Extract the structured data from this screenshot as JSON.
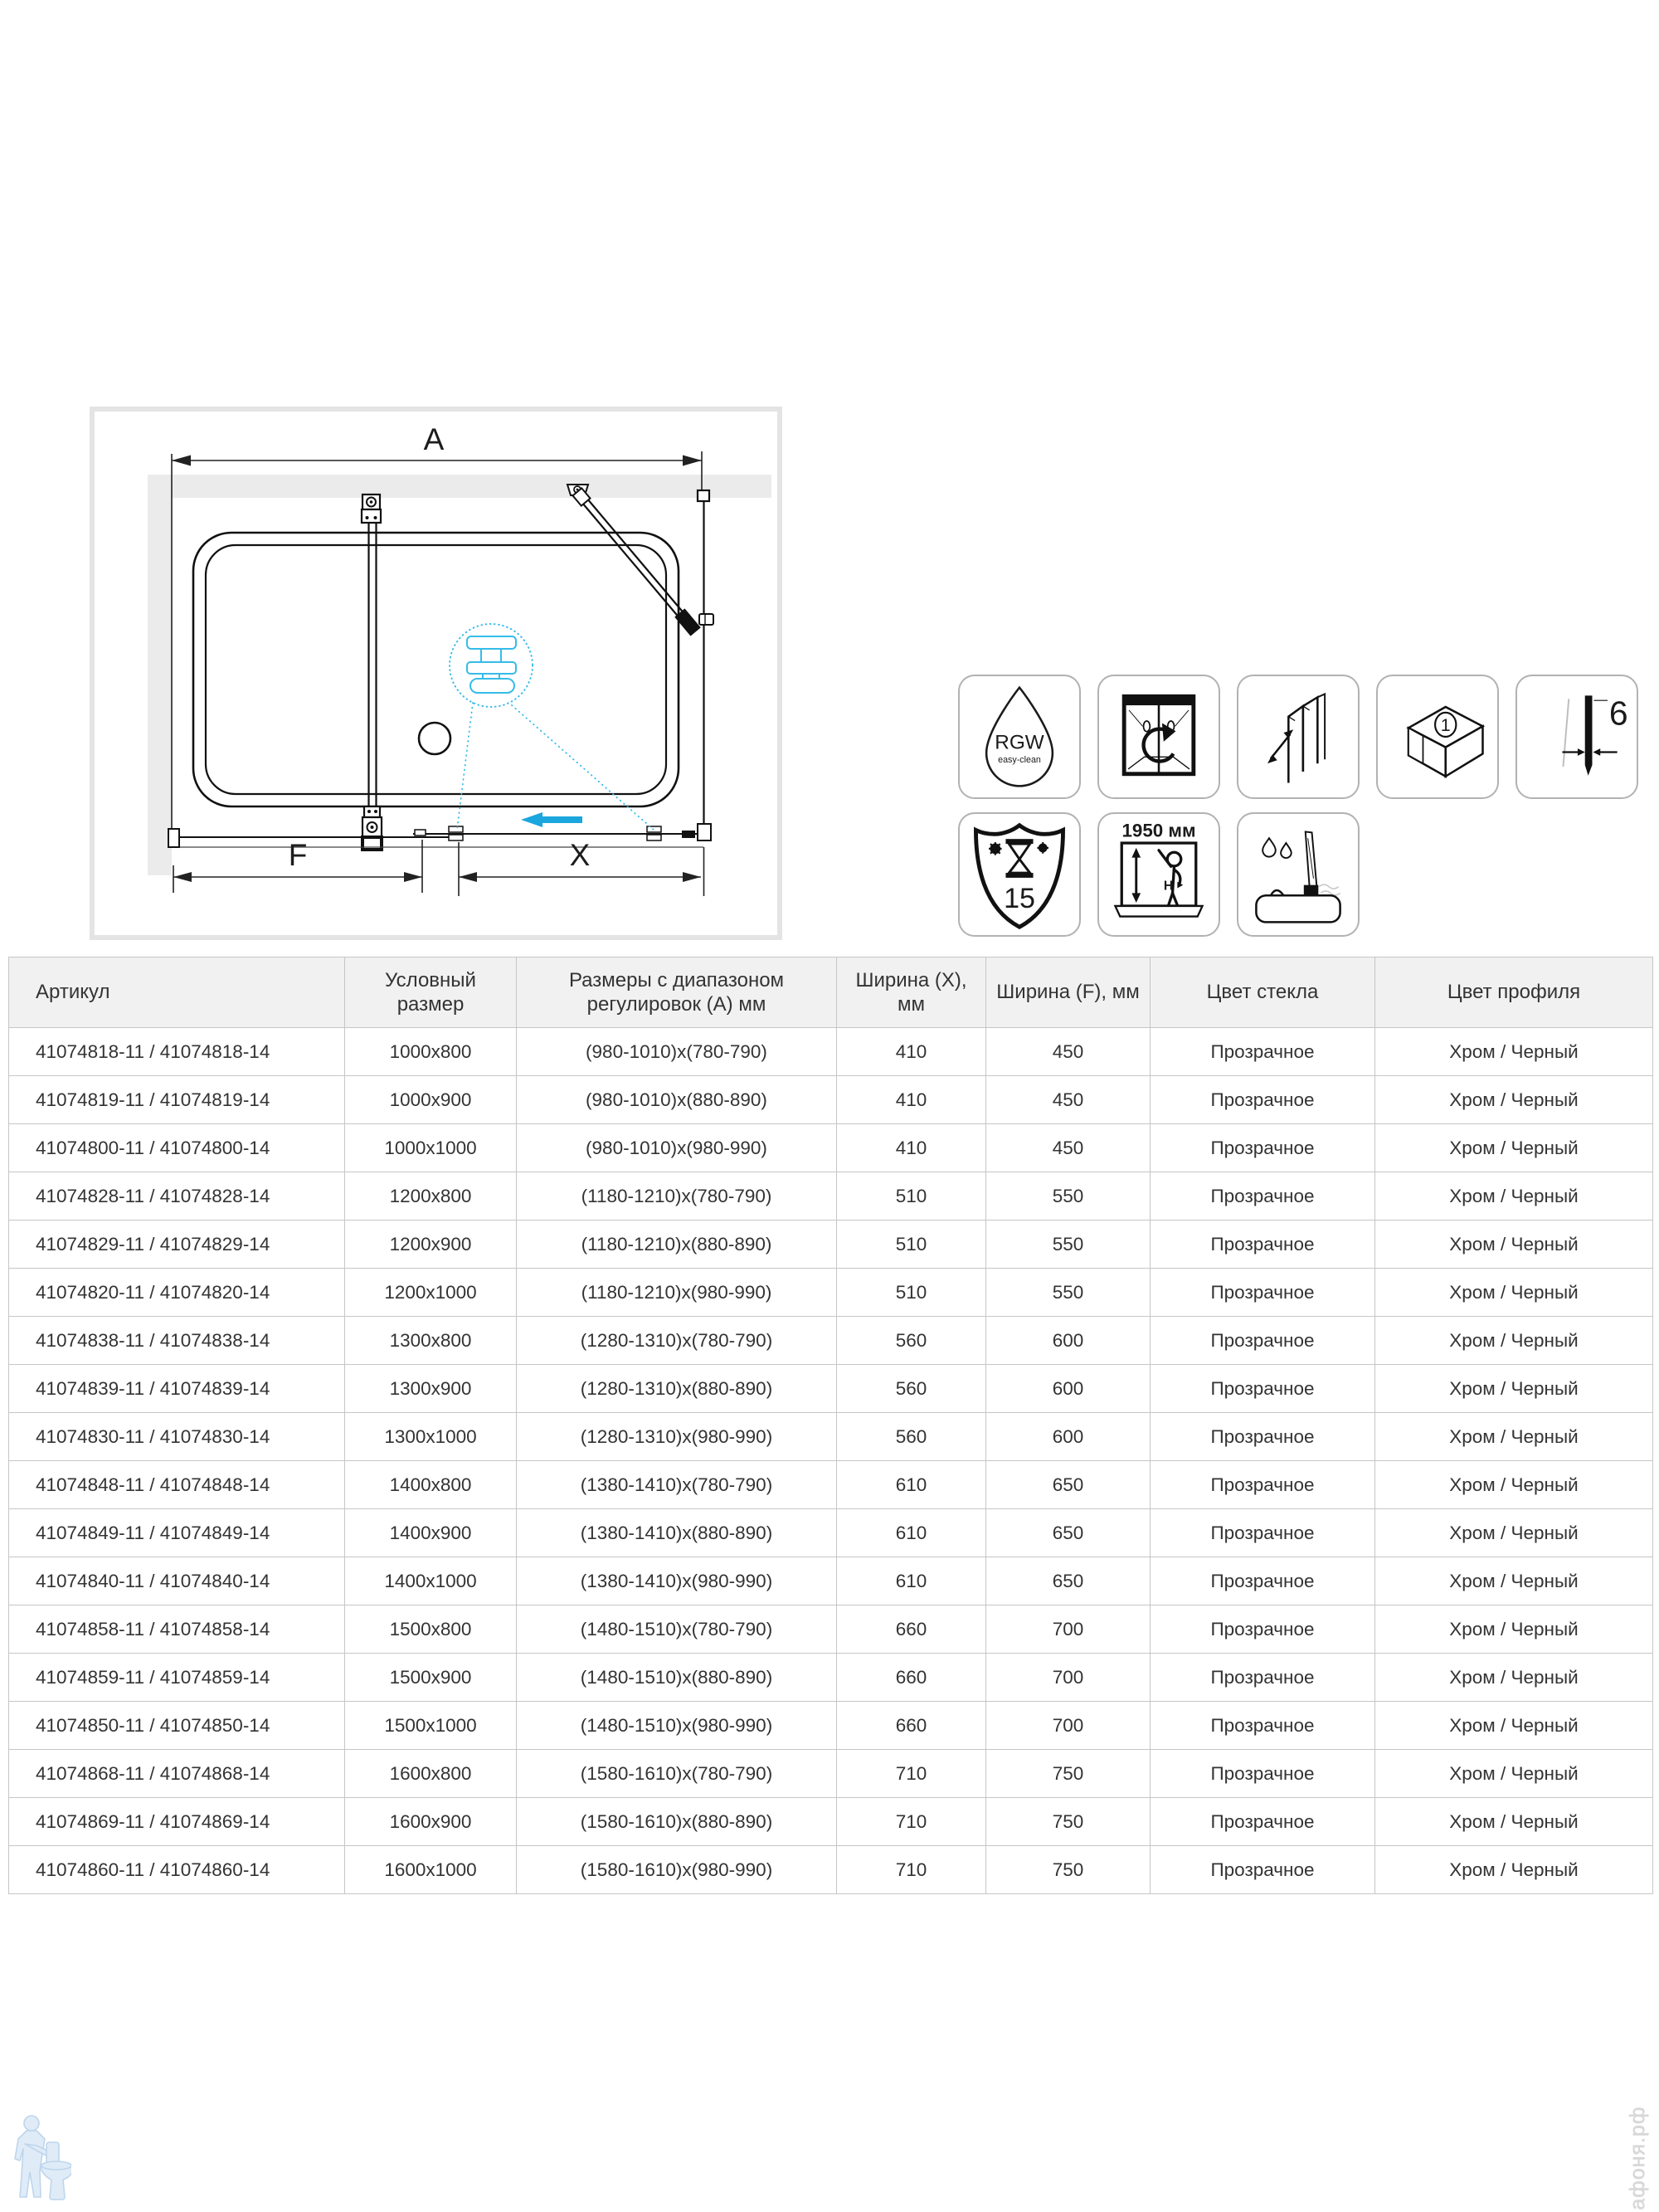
{
  "drawing": {
    "labels": {
      "a": "A",
      "f": "F",
      "x": "X"
    },
    "colors": {
      "wall": "#ebebeb",
      "frame": "#e4e4e4",
      "accent_arrow": "#1ca6de",
      "accent_detail": "#35bce8"
    }
  },
  "icons": {
    "row1": [
      {
        "name": "rgw-easy-clean",
        "line1": "RGW",
        "line2": "easy-clean"
      },
      {
        "name": "reversible-installation"
      },
      {
        "name": "adjustment-profile"
      },
      {
        "name": "one-package",
        "number": "1"
      },
      {
        "name": "glass-thickness-6mm",
        "value": "6"
      }
    ],
    "row2": [
      {
        "name": "warranty-15-years",
        "value": "15"
      },
      {
        "name": "height-1950",
        "label": "1950 мм",
        "letter": "H"
      },
      {
        "name": "splash-guard-on-tub"
      }
    ]
  },
  "table": {
    "headers": [
      "Артикул",
      "Условный размер",
      "Размеры с диапазоном регулировок (А) мм",
      "Ширина (X), мм",
      "Ширина (F), мм",
      "Цвет стекла",
      "Цвет профиля"
    ],
    "rows": [
      [
        "41074818-11 / 41074818-14",
        "1000x800",
        "(980-1010)x(780-790)",
        "410",
        "450",
        "Прозрачное",
        "Хром / Черный"
      ],
      [
        "41074819-11 / 41074819-14",
        "1000x900",
        "(980-1010)x(880-890)",
        "410",
        "450",
        "Прозрачное",
        "Хром / Черный"
      ],
      [
        "41074800-11 / 41074800-14",
        "1000x1000",
        "(980-1010)x(980-990)",
        "410",
        "450",
        "Прозрачное",
        "Хром / Черный"
      ],
      [
        "41074828-11 / 41074828-14",
        "1200x800",
        "(1180-1210)x(780-790)",
        "510",
        "550",
        "Прозрачное",
        "Хром / Черный"
      ],
      [
        "41074829-11 / 41074829-14",
        "1200x900",
        "(1180-1210)x(880-890)",
        "510",
        "550",
        "Прозрачное",
        "Хром / Черный"
      ],
      [
        "41074820-11 / 41074820-14",
        "1200x1000",
        "(1180-1210)x(980-990)",
        "510",
        "550",
        "Прозрачное",
        "Хром / Черный"
      ],
      [
        "41074838-11 / 41074838-14",
        "1300x800",
        "(1280-1310)x(780-790)",
        "560",
        "600",
        "Прозрачное",
        "Хром / Черный"
      ],
      [
        "41074839-11 / 41074839-14",
        "1300x900",
        "(1280-1310)x(880-890)",
        "560",
        "600",
        "Прозрачное",
        "Хром / Черный"
      ],
      [
        "41074830-11 / 41074830-14",
        "1300x1000",
        "(1280-1310)x(980-990)",
        "560",
        "600",
        "Прозрачное",
        "Хром / Черный"
      ],
      [
        "41074848-11 / 41074848-14",
        "1400x800",
        "(1380-1410)x(780-790)",
        "610",
        "650",
        "Прозрачное",
        "Хром / Черный"
      ],
      [
        "41074849-11 / 41074849-14",
        "1400x900",
        "(1380-1410)x(880-890)",
        "610",
        "650",
        "Прозрачное",
        "Хром / Черный"
      ],
      [
        "41074840-11 / 41074840-14",
        "1400x1000",
        "(1380-1410)x(980-990)",
        "610",
        "650",
        "Прозрачное",
        "Хром / Черный"
      ],
      [
        "41074858-11 / 41074858-14",
        "1500x800",
        "(1480-1510)x(780-790)",
        "660",
        "700",
        "Прозрачное",
        "Хром / Черный"
      ],
      [
        "41074859-11 / 41074859-14",
        "1500x900",
        "(1480-1510)x(880-890)",
        "660",
        "700",
        "Прозрачное",
        "Хром / Черный"
      ],
      [
        "41074850-11 / 41074850-14",
        "1500x1000",
        "(1480-1510)x(980-990)",
        "660",
        "700",
        "Прозрачное",
        "Хром / Черный"
      ],
      [
        "41074868-11 / 41074868-14",
        "1600x800",
        "(1580-1610)x(780-790)",
        "710",
        "750",
        "Прозрачное",
        "Хром / Черный"
      ],
      [
        "41074869-11 / 41074869-14",
        "1600x900",
        "(1580-1610)x(880-890)",
        "710",
        "750",
        "Прозрачное",
        "Хром / Черный"
      ],
      [
        "41074860-11 / 41074860-14",
        "1600x1000",
        "(1580-1610)x(980-990)",
        "710",
        "750",
        "Прозрачное",
        "Хром / Черный"
      ]
    ]
  },
  "watermarks": {
    "bottom_right": "афоня.рф"
  }
}
